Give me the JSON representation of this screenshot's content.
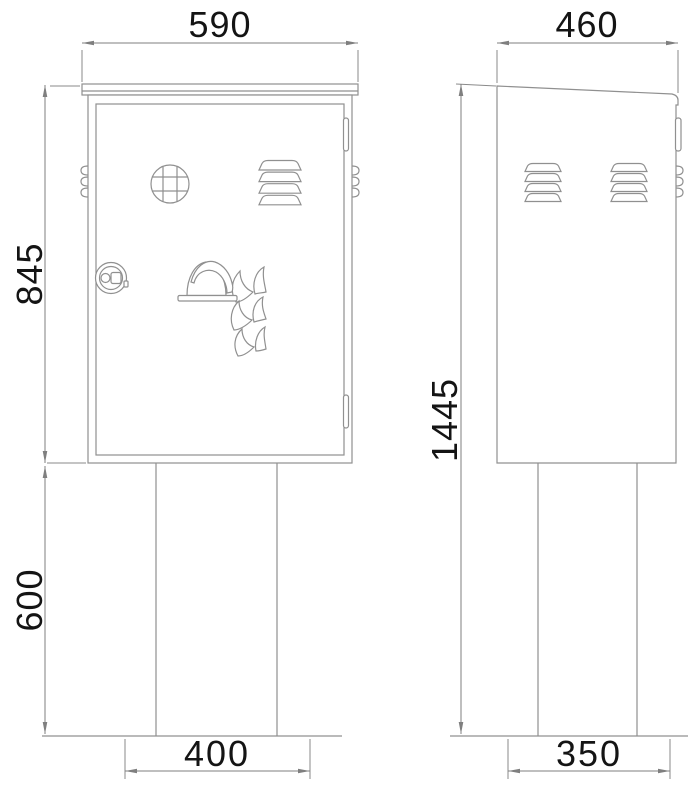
{
  "page": {
    "background": "#ffffff",
    "type": "technical-drawing",
    "subject": "fire equipment cabinet on pedestal, dimensioned front and side views"
  },
  "style": {
    "line_color": "#909090",
    "dim_line_color": "#7f7f7f",
    "text_color": "#141414"
  },
  "views": {
    "front": {
      "label": "front-view",
      "dims": {
        "overall_width": "590",
        "cabinet_height": "845",
        "pedestal_height": "600",
        "base_width": "400"
      },
      "features": [
        "round-grid-vent",
        "louvered-vent",
        "cam-lock",
        "fire-helmet-and-flames-logo",
        "door-hinges",
        "side-louver-edges",
        "pedestal",
        "ground-line"
      ]
    },
    "side": {
      "label": "side-view",
      "dims": {
        "overall_depth": "460",
        "total_height": "1445",
        "base_depth": "350"
      },
      "features": [
        "sloped-roof-with-drip-edge",
        "louvered-vent-rear",
        "louvered-vent-front",
        "hinge-edge",
        "side-louver-edges",
        "pedestal",
        "ground-line"
      ]
    }
  }
}
